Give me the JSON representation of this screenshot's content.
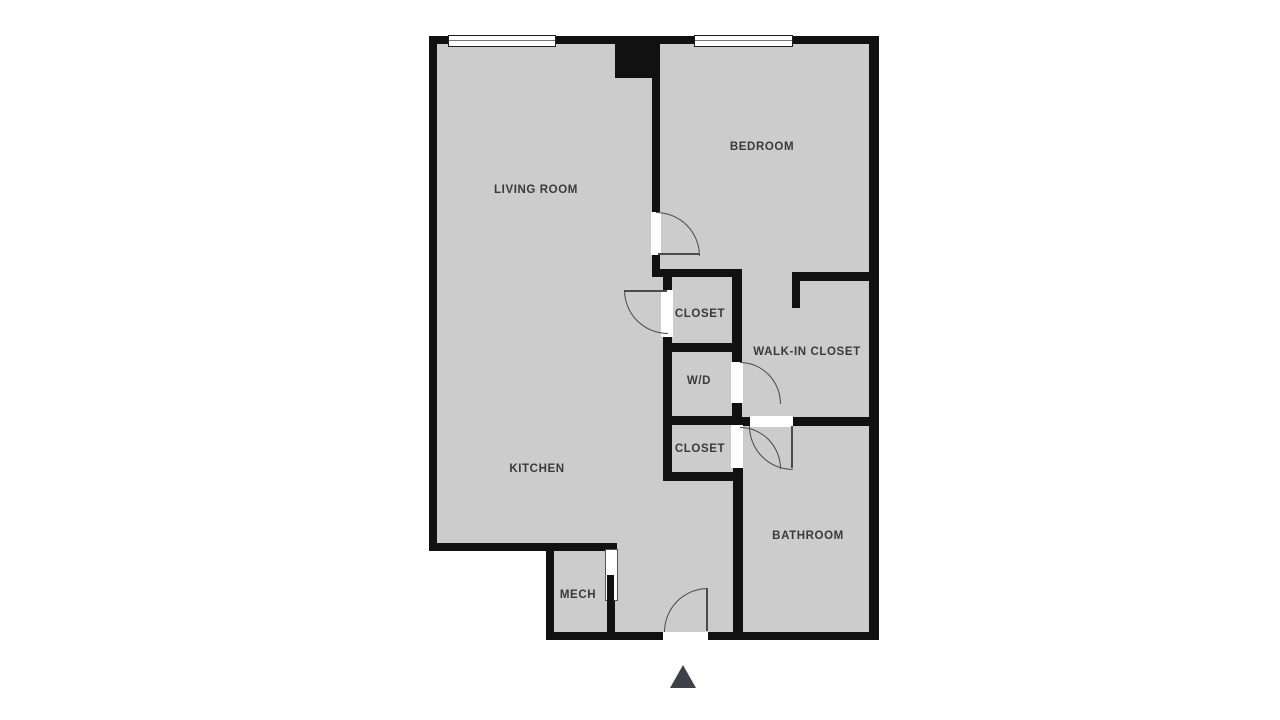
{
  "rooms": [
    {
      "id": "living-room",
      "label": "LIVING ROOM"
    },
    {
      "id": "bedroom",
      "label": "BEDROOM"
    },
    {
      "id": "closet-upper",
      "label": "CLOSET"
    },
    {
      "id": "walk-in-closet",
      "label": "WALK-IN CLOSET"
    },
    {
      "id": "washer-dryer",
      "label": "W/D"
    },
    {
      "id": "closet-lower",
      "label": "CLOSET"
    },
    {
      "id": "kitchen",
      "label": "KITCHEN"
    },
    {
      "id": "bathroom",
      "label": "BATHROOM"
    },
    {
      "id": "mech",
      "label": "MECH"
    }
  ],
  "icons": [
    {
      "name": "entrance-arrow-icon",
      "shape": "triangle-up",
      "meaning": "main entry direction"
    }
  ],
  "colors": {
    "background": "#ffffff",
    "floor": "#cccccc",
    "wall": "#111111",
    "label_text": "#3a3a3a",
    "door_arc": "#4a4a4a",
    "entry_arrow": "#3e4147"
  }
}
